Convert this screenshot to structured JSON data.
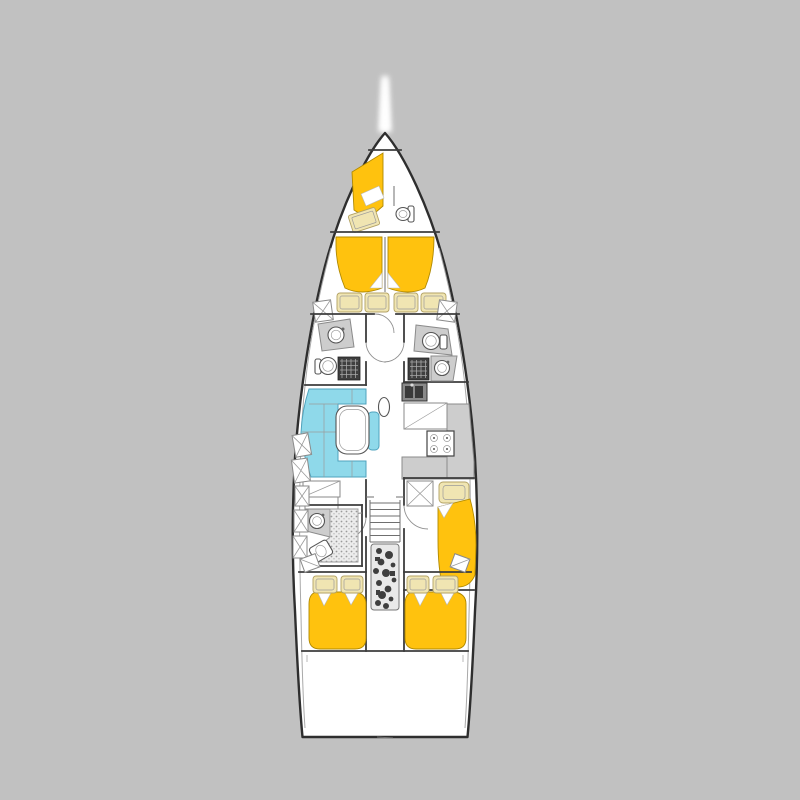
{
  "scene": {
    "type": "sailing-yacht-interior-deck-plan",
    "view": "top-down",
    "text_content": "none-visible"
  },
  "canvas": {
    "width": 800,
    "height": 800,
    "background": "#c1c1c1"
  },
  "colors": {
    "canvas_bg": "#c1c1c1",
    "hull_fill": "#ffffff",
    "hull_outline": "#2e2e2e",
    "wall": "#3d3d3d",
    "inner_line": "#6f6f6f",
    "bed_yellow": "#ffc20e",
    "bed_edge": "#b08900",
    "cushion_cream": "#f0e5b2",
    "cushion_edge": "#b3a264",
    "sofa_blue": "#8fd9ea",
    "sofa_edge": "#4fa3bd",
    "counter_gray": "#cdcdcd",
    "dark_fixture": "#3f3f3f",
    "engine_dark": "#2d2d2d"
  },
  "features": [
    "bowsprit",
    "anchor-locker",
    "crew-cabin-berth",
    "crew-cabin-seat",
    "crew-head-toilet",
    "owner-cabin-v-berth",
    "owner-cabin-pillows",
    "port-head-sink",
    "port-head-toilet",
    "port-head-shower-grate",
    "starboard-head-toilet",
    "starboard-head-shower-grate",
    "starboard-head-sink",
    "salon-u-sofa",
    "salon-table",
    "mast",
    "galley-sink",
    "galley-stove",
    "galley-counter",
    "nav-station-cabinets",
    "companionway-stairs",
    "engine-compartment",
    "starboard-single-cabin-berth",
    "port-aft-head",
    "port-aft-double-berth",
    "starboard-aft-double-berth",
    "stern-lazarette"
  ]
}
